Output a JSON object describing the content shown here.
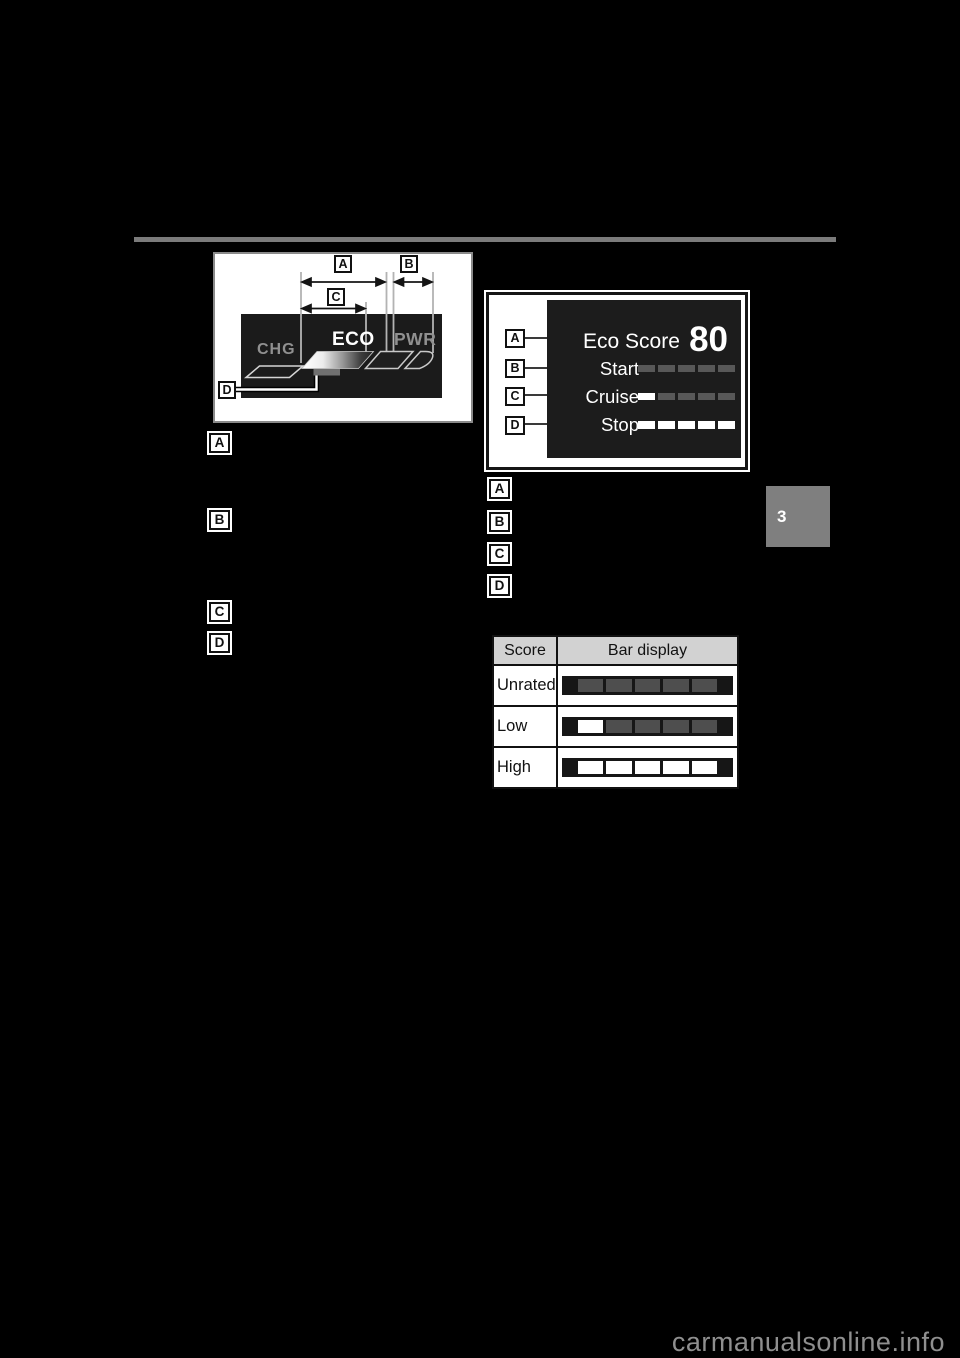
{
  "page": {
    "section_tab": "3",
    "watermark": "carmanualsonline.info"
  },
  "colors": {
    "page_background": "#000000",
    "display_background": "#1c1c1c",
    "segment_dim": "#4e4e4e",
    "segment_lit": "#ffffff",
    "table_header_background": "#d2d2d2",
    "section_tab_background": "#7f7f7f",
    "divider": "#7b7b7b"
  },
  "hsi_figure": {
    "zone_chg": "CHG",
    "zone_eco": "ECO",
    "zone_pwr": "PWR",
    "callout_a": "A",
    "callout_b": "B",
    "callout_c": "C",
    "callout_d": "D"
  },
  "hsi_legend": {
    "items": [
      "A",
      "B",
      "C",
      "D"
    ]
  },
  "eco_display": {
    "title": "Eco Score",
    "score": "80",
    "callouts": [
      "A",
      "B",
      "C",
      "D"
    ],
    "rows": [
      {
        "label": "Start",
        "segments": [
          "dim",
          "dim",
          "dim",
          "dim",
          "dim"
        ]
      },
      {
        "label": "Cruise",
        "segments": [
          "lit",
          "dim",
          "dim",
          "dim",
          "dim"
        ]
      },
      {
        "label": "Stop",
        "segments": [
          "lit",
          "lit",
          "lit",
          "lit",
          "lit"
        ]
      }
    ]
  },
  "eco_legend": {
    "items": [
      "A",
      "B",
      "C",
      "D"
    ]
  },
  "score_table": {
    "headers": [
      "Score",
      "Bar display"
    ],
    "rows": [
      {
        "score": "Unrated",
        "segments": [
          "dim",
          "dim",
          "dim",
          "dim",
          "dim"
        ]
      },
      {
        "score": "Low",
        "segments": [
          "lit",
          "dim",
          "dim",
          "dim",
          "dim"
        ]
      },
      {
        "score": "High",
        "segments": [
          "lit",
          "lit",
          "lit",
          "lit",
          "lit"
        ]
      }
    ]
  }
}
